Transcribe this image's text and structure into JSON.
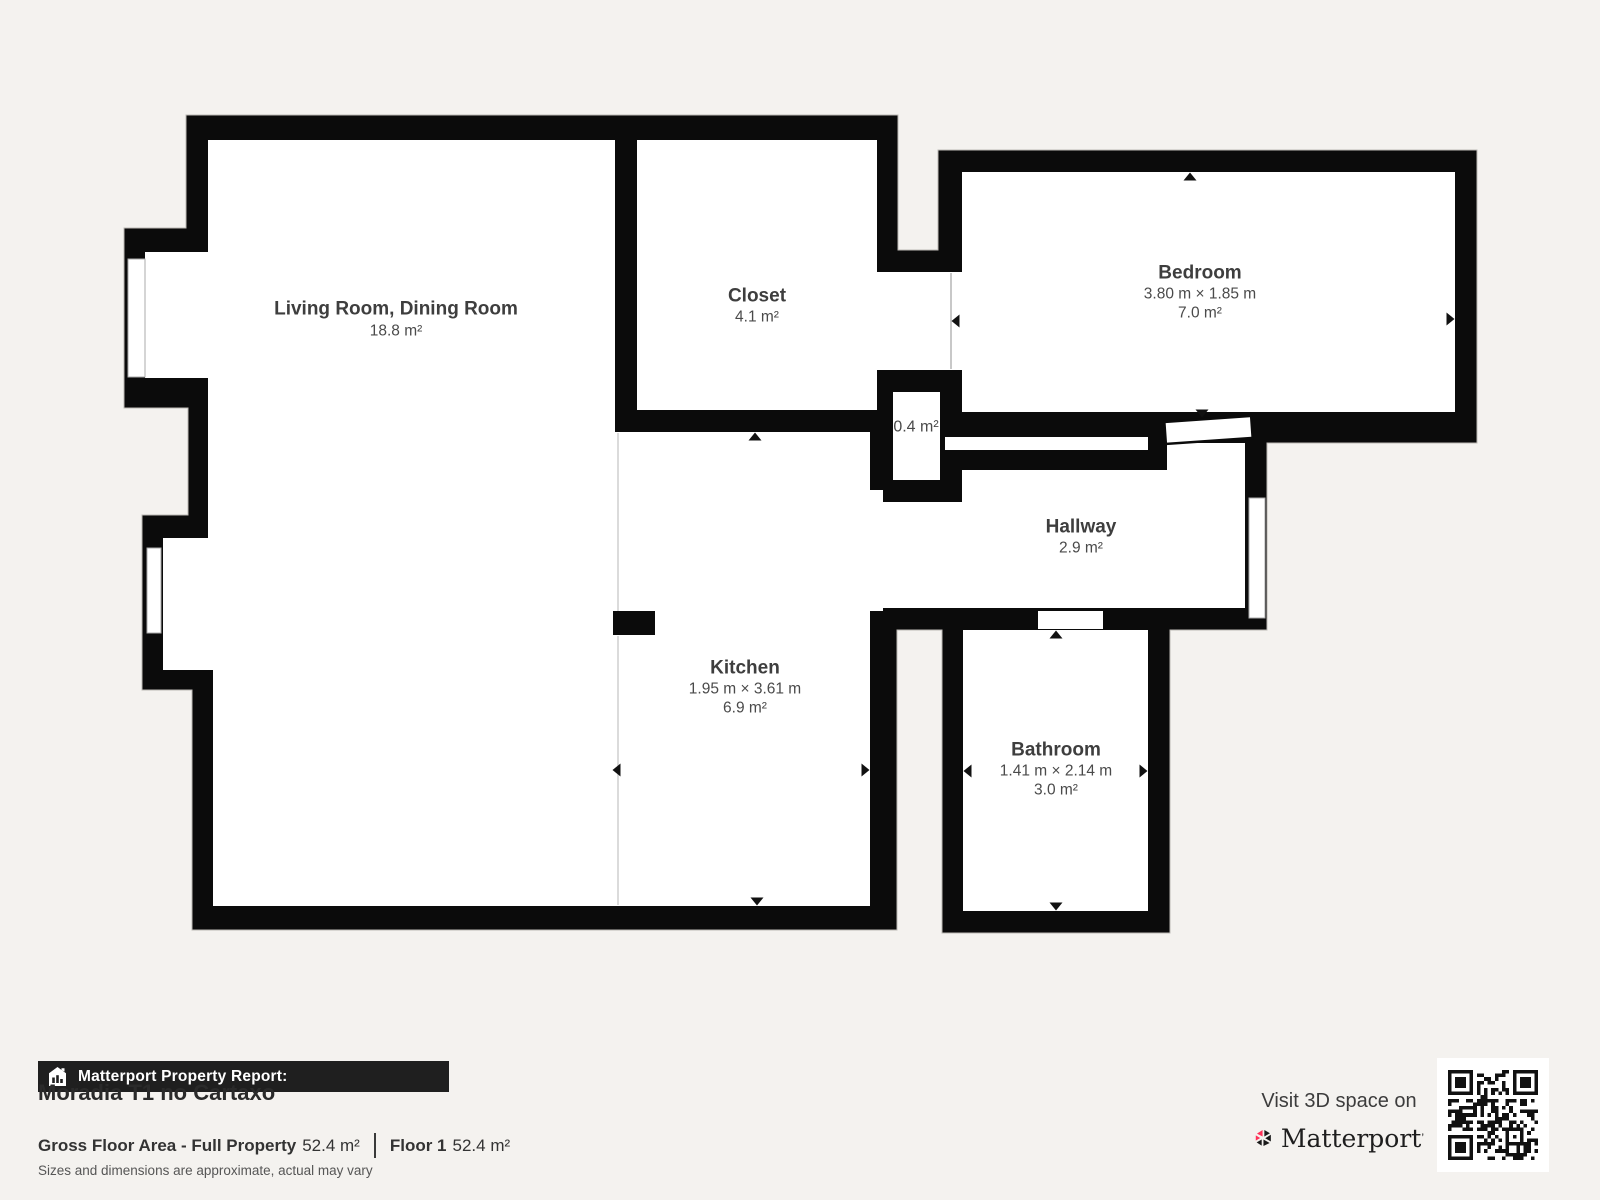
{
  "plan": {
    "rooms": {
      "living": {
        "name": "Living Room, Dining Room",
        "area": "18.8 m²"
      },
      "closet": {
        "name": "Closet",
        "area": "4.1 m²"
      },
      "bedroom": {
        "name": "Bedroom",
        "dims": "3.80 m × 1.85 m",
        "area": "7.0 m²"
      },
      "small_closet": {
        "area": "0.4 m²"
      },
      "hallway": {
        "name": "Hallway",
        "area": "2.9 m²"
      },
      "kitchen": {
        "name": "Kitchen",
        "dims": "1.95 m × 3.61 m",
        "area": "6.9 m²"
      },
      "bathroom": {
        "name": "Bathroom",
        "dims": "1.41 m × 2.14 m",
        "area": "3.0 m²"
      }
    },
    "colors": {
      "wall": "#0b0b0b",
      "background": "#f4f2ef",
      "room": "#ffffff",
      "label": "#3e3e3e"
    }
  },
  "footer": {
    "report_label": "Matterport Property Report:",
    "title": "Moradia T1 no Cartaxo",
    "gross_label": "Gross Floor Area - Full Property",
    "gross_value": "52.4 m²",
    "floor_label": "Floor 1",
    "floor_value": "52.4 m²",
    "disclaimer": "Sizes and dimensions are approximate, actual may vary"
  },
  "cta": {
    "visit_text": "Visit 3D space on",
    "brand": "Matterport",
    "brand_mark": "’",
    "accent_pink": "#ff3158"
  }
}
